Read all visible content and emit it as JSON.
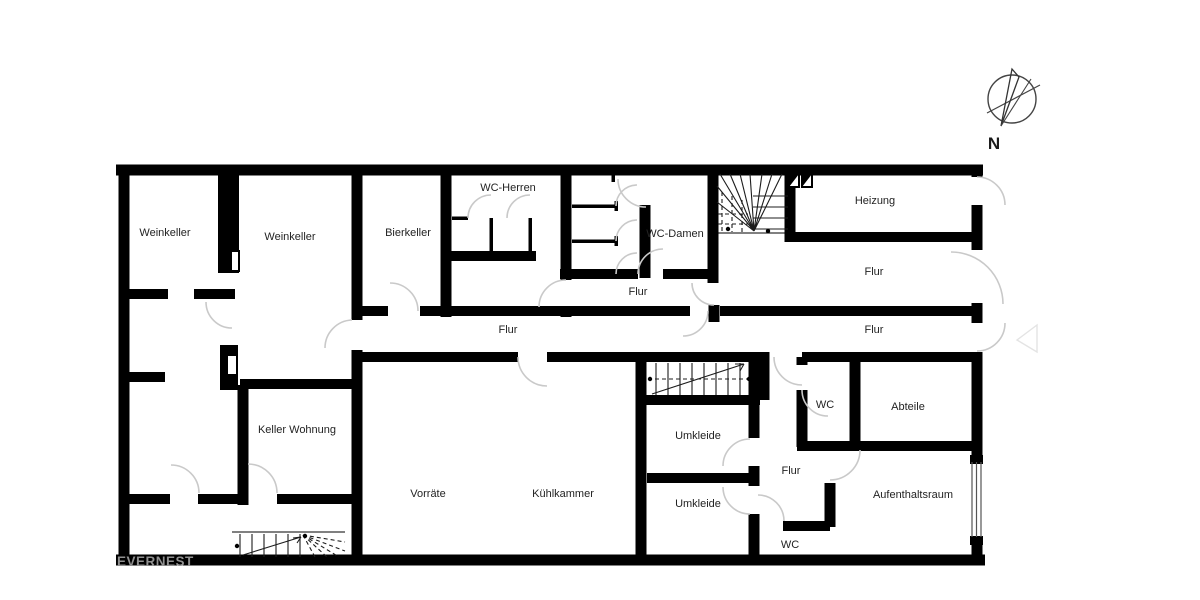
{
  "colors": {
    "wall": "#000000",
    "door_arc": "#c9c9c9",
    "label": "#232323",
    "watermark": "#909090"
  },
  "compass": {
    "label": "N"
  },
  "watermark": {
    "text": "EVERNEST"
  },
  "rooms": [
    {
      "id": "weinkeller-1",
      "label": "Weinkeller"
    },
    {
      "id": "weinkeller-2",
      "label": "Weinkeller"
    },
    {
      "id": "bierkeller",
      "label": "Bierkeller"
    },
    {
      "id": "wc-herren",
      "label": "WC-Herren"
    },
    {
      "id": "wc-damen",
      "label": "WC-Damen"
    },
    {
      "id": "heizung",
      "label": "Heizung"
    },
    {
      "id": "flur-oben-rechts",
      "label": "Flur"
    },
    {
      "id": "flur-mitte",
      "label": "Flur"
    },
    {
      "id": "flur-haupt",
      "label": "Flur"
    },
    {
      "id": "flur-haupt-rechts",
      "label": "Flur"
    },
    {
      "id": "keller-wohnung",
      "label": "Keller Wohnung"
    },
    {
      "id": "vorraete",
      "label": "Vorräte"
    },
    {
      "id": "kuehlkammer",
      "label": "Kühlkammer"
    },
    {
      "id": "umkleide-1",
      "label": "Umkleide"
    },
    {
      "id": "umkleide-2",
      "label": "Umkleide"
    },
    {
      "id": "flur-unten-rechts",
      "label": "Flur"
    },
    {
      "id": "wc-rechts",
      "label": "WC"
    },
    {
      "id": "abteile",
      "label": "Abteile"
    },
    {
      "id": "aufenthaltsraum",
      "label": "Aufenthaltsraum"
    },
    {
      "id": "wc-unten",
      "label": "WC"
    }
  ]
}
